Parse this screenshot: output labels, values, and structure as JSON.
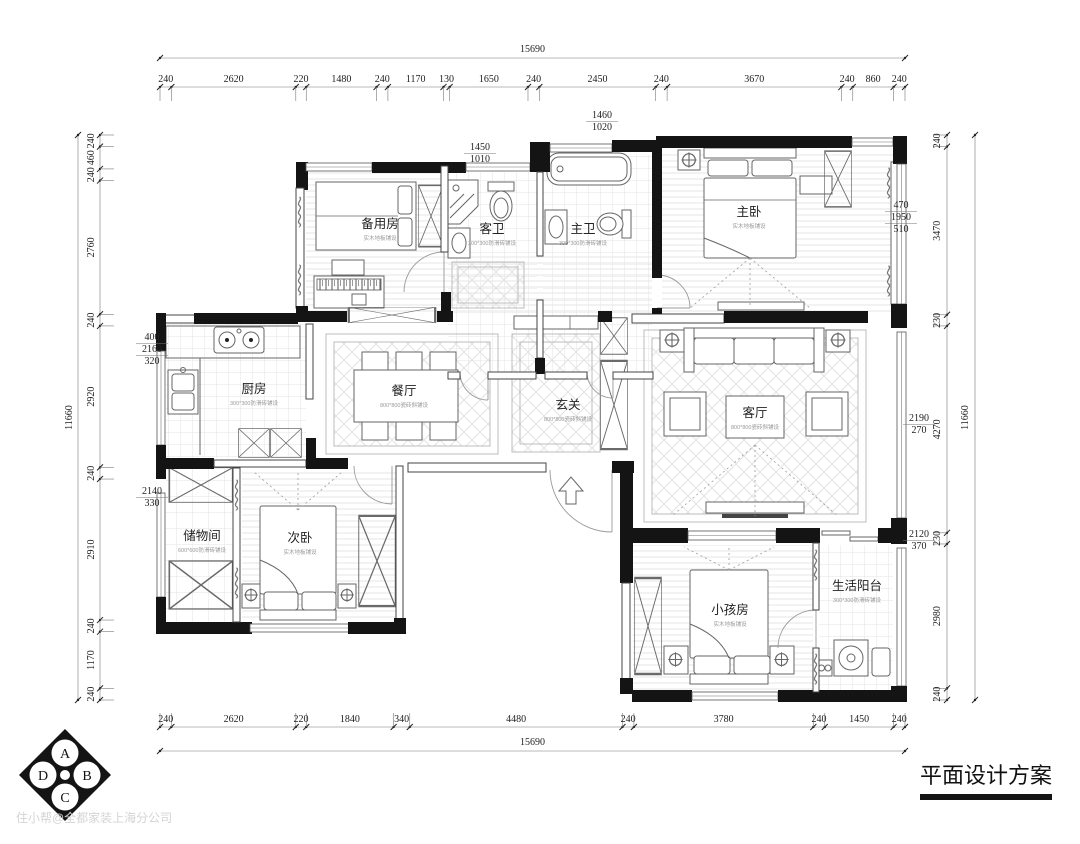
{
  "title": "平面设计方案",
  "watermark": "住小帮@全都家装上海分公司",
  "compass": {
    "a": "A",
    "b": "B",
    "c": "C",
    "d": "D"
  },
  "rooms": {
    "spare": {
      "name": "备用房",
      "sub": "实木地板铺设"
    },
    "guest_bath": {
      "name": "客卫",
      "sub": "300*300防滑砖铺设"
    },
    "master_bath": {
      "name": "主卫",
      "sub": "300*300防滑砖铺设"
    },
    "master_bed": {
      "name": "主卧",
      "sub": "实木地板铺设"
    },
    "kitchen": {
      "name": "厨房",
      "sub": "300*300防滑砖铺设"
    },
    "dining": {
      "name": "餐厅",
      "sub": "800*800瓷砖斜铺设"
    },
    "foyer": {
      "name": "玄关",
      "sub": "800*800瓷砖斜铺设"
    },
    "living": {
      "name": "客厅",
      "sub": "800*800瓷砖斜铺设"
    },
    "storage": {
      "name": "储物间",
      "sub": "600*600防滑砖铺设"
    },
    "second_bed": {
      "name": "次卧",
      "sub": "实木地板铺设"
    },
    "kids": {
      "name": "小孩房",
      "sub": "实木地板铺设"
    },
    "balcony": {
      "name": "生活阳台",
      "sub": "300*300防滑砖铺设"
    }
  },
  "dimensions": {
    "top": {
      "total": "15690",
      "segments": [
        "240",
        "2620",
        "220",
        "1480",
        "240",
        "1170",
        "130",
        "1650",
        "240",
        "2450",
        "240",
        "3670",
        "240",
        "860",
        "240"
      ]
    },
    "bottom": {
      "total": "15690",
      "segments": [
        "240",
        "2620",
        "220",
        "1840",
        "340",
        "4480",
        "240",
        "3780",
        "240",
        "1450",
        "240"
      ]
    },
    "left": {
      "total": "11660",
      "segments": [
        "240",
        "460",
        "240",
        "2760",
        "240",
        "2920",
        "240",
        "2910",
        "240",
        "1170",
        "240"
      ]
    },
    "right": {
      "total": "11660",
      "segments": [
        "240",
        "3470",
        "230",
        "4270",
        "230",
        "2980",
        "240"
      ]
    },
    "inner": {
      "bath_guest": [
        "1450",
        "1010"
      ],
      "bath_master": [
        "1460",
        "1020"
      ],
      "master_right": [
        "470",
        "1950",
        "510"
      ],
      "kitchen_left": [
        "400",
        "2160",
        "320"
      ],
      "storage_left": [
        "2140",
        "330"
      ],
      "living_right": [
        "2190",
        "270"
      ],
      "balcony_right": [
        "2120",
        "370"
      ]
    }
  },
  "colors": {
    "wall": "#141414",
    "dim_text": "#222222",
    "watermark": "#d4d4d4"
  }
}
